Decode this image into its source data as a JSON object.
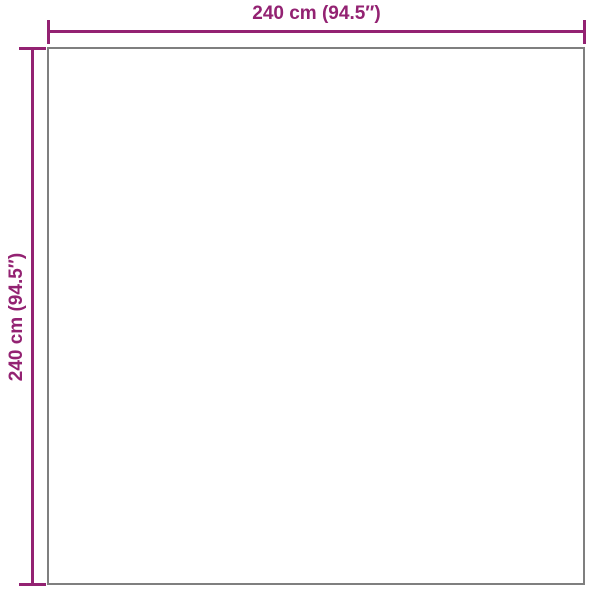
{
  "diagram": {
    "type": "product-dimension-diagram",
    "shape": "square",
    "width_label": "240 cm (94.5″)",
    "height_label": "240 cm (94.5″)",
    "width_value_cm": 240,
    "width_value_in": 94.5,
    "height_value_cm": 240,
    "height_value_in": 94.5
  },
  "colors": {
    "accent": "#932272",
    "outline": "#7f7f7f",
    "background": "#ffffff"
  }
}
